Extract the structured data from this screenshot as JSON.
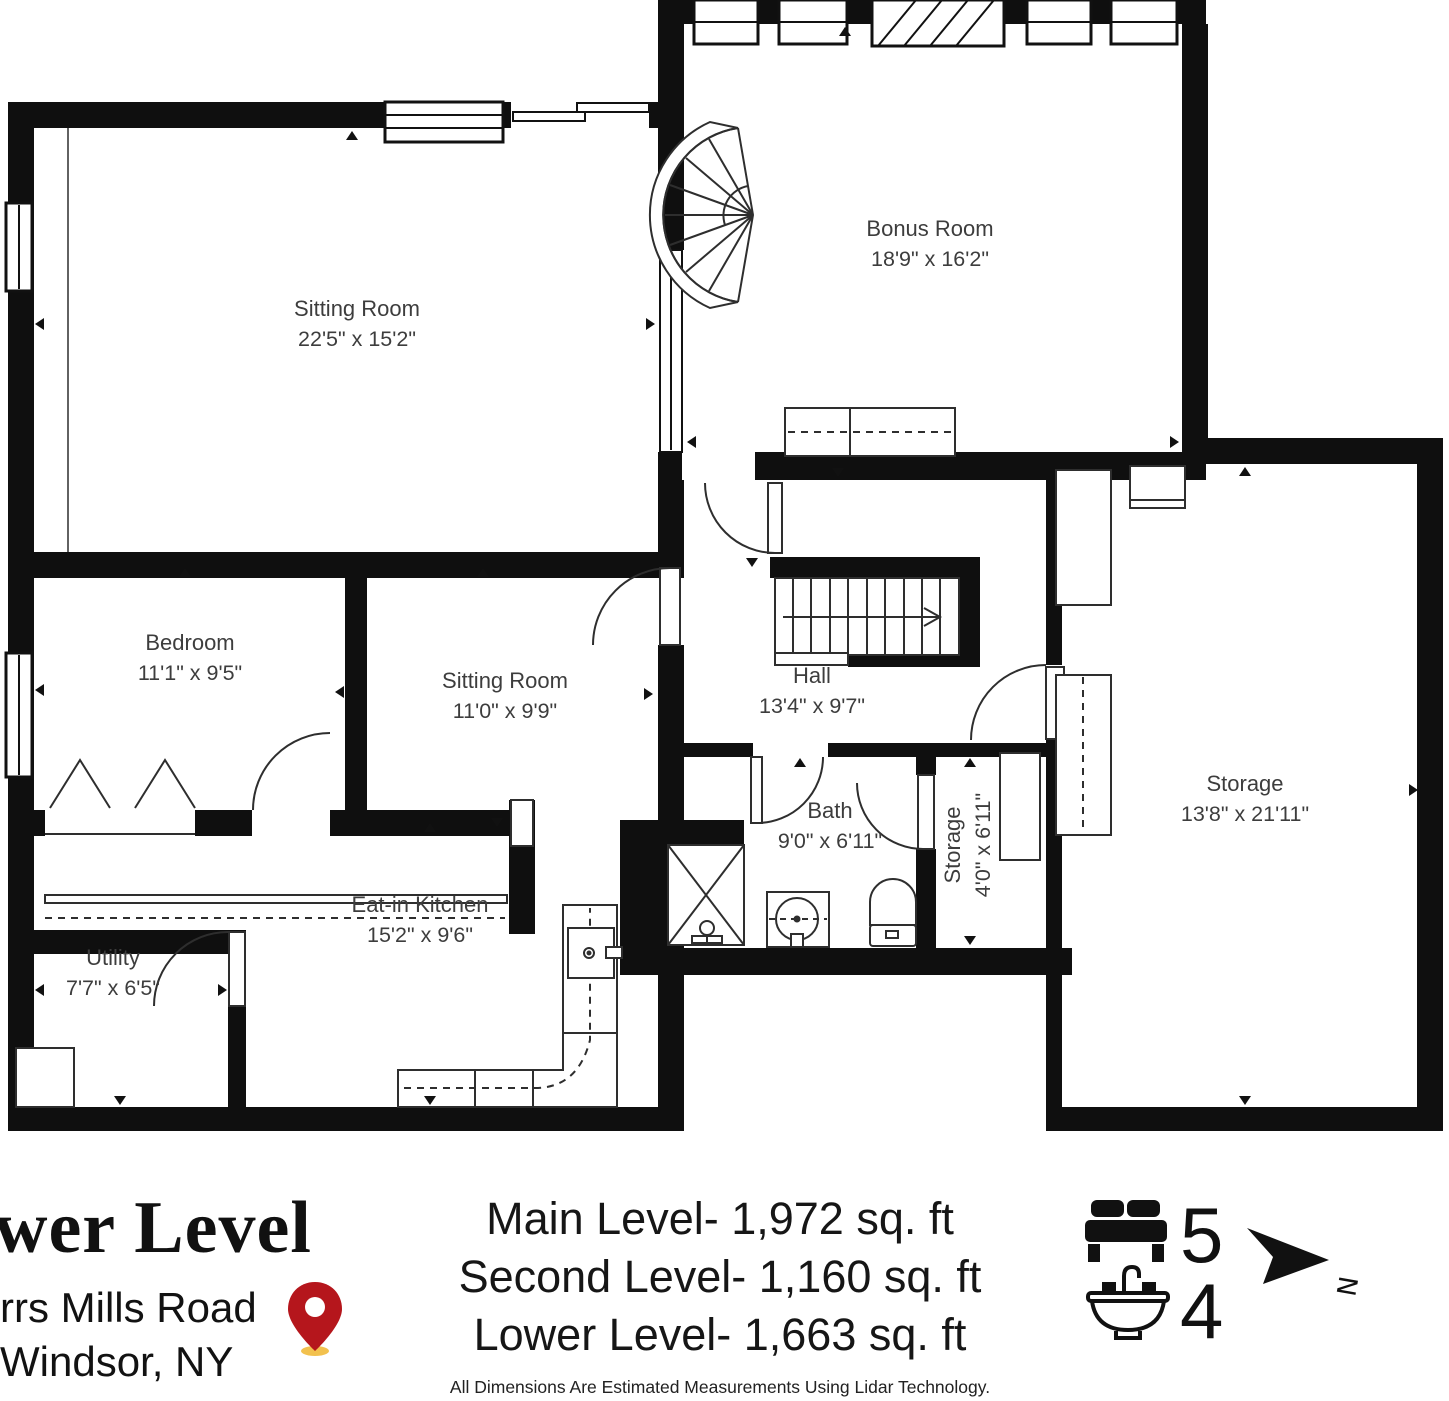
{
  "plan": {
    "rooms": [
      {
        "id": "sitting-room-1",
        "name": "Sitting Room",
        "dims": "22'5\" x 15'2\""
      },
      {
        "id": "bonus-room",
        "name": "Bonus Room",
        "dims": "18'9\" x 16'2\""
      },
      {
        "id": "bedroom",
        "name": "Bedroom",
        "dims": "11'1\" x 9'5\""
      },
      {
        "id": "sitting-room-2",
        "name": "Sitting Room",
        "dims": "11'0\" x 9'9\""
      },
      {
        "id": "hall",
        "name": "Hall",
        "dims": "13'4\" x 9'7\""
      },
      {
        "id": "storage-large",
        "name": "Storage",
        "dims": "13'8\" x 21'11\""
      },
      {
        "id": "bath",
        "name": "Bath",
        "dims": "9'0\" x 6'11\""
      },
      {
        "id": "storage-small",
        "name": "Storage",
        "dims": "4'0\" x 6'11\""
      },
      {
        "id": "eat-in-kitchen",
        "name": "Eat-in Kitchen",
        "dims": "15'2\" x 9'6\""
      },
      {
        "id": "utility",
        "name": "Utility",
        "dims": "7'7\" x 6'5\""
      }
    ]
  },
  "footer": {
    "title": "wer Level",
    "address_line1": "rrs Mills Road",
    "address_line2": "Windsor, NY",
    "levels": [
      {
        "label": "Main Level- 1,972 sq. ft"
      },
      {
        "label": "Second Level- 1,160 sq. ft"
      },
      {
        "label": "Lower Level- 1,663 sq. ft"
      }
    ],
    "stats": {
      "beds": "5",
      "baths": "4"
    },
    "compass_letter": "N",
    "disclaimer": "All Dimensions Are Estimated Measurements Using Lidar Technology.",
    "icons": [
      "bed-icon",
      "sink-icon",
      "map-pin-icon",
      "compass-north-icon"
    ]
  },
  "colors": {
    "wall": "#0f0f0f",
    "line": "#2e2e2e",
    "pin_red": "#b5161c",
    "pin_shadow": "#f2c14e"
  }
}
